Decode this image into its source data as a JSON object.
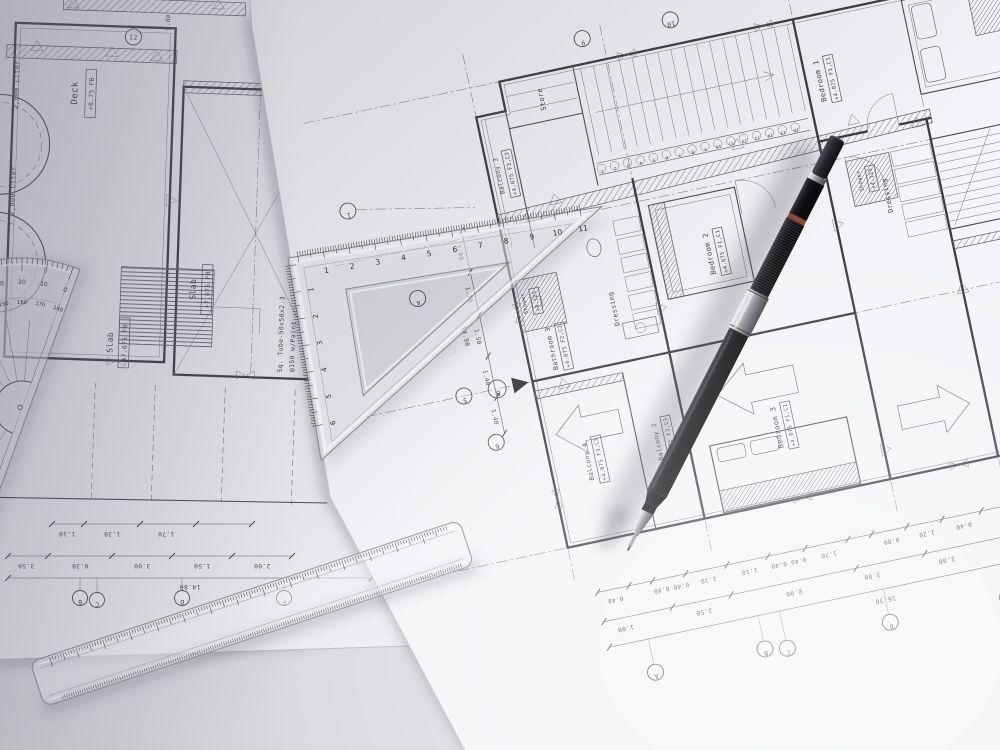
{
  "scene": {
    "description": "Top-down photograph of architectural floor-plan blueprints on a desk with a protractor, a set square, a 15 cm ruler and a black clutch pencil",
    "colors": {
      "desk": "#d9dade",
      "paper_left": "#ebecef",
      "paper_right": "#f3f4f7",
      "ink": "#44444c",
      "wall": "#3a3a43",
      "pencil_body": "#121214",
      "pencil_metal": "#c9c9ce",
      "pencil_ring": "#8a4a38"
    }
  },
  "left_sheet": {
    "deck_room": {
      "name": "Deck",
      "level": "+0.75 FB"
    },
    "tank_label_1": "2,000 Liter",
    "tank_label_2": "2,000 Liter",
    "bubble_12": "12",
    "dim_0_80": "0.80",
    "slab_1": {
      "name": "Slab",
      "level": "+7.675 FB"
    },
    "slab_2": {
      "name": "Slab",
      "level": "+7.675 FB"
    },
    "note_line_1": "Sq. Tube-50x50x2.3",
    "note_line_2": "@150 w/Paint",
    "dims_row1": [
      "1.10",
      "1.30",
      "1.70"
    ],
    "dims_row2": [
      "3.50",
      "0.30",
      "3.00",
      "1.50",
      "2.00"
    ],
    "dim_total": "14.80",
    "grid_bubbles": [
      "B",
      "C",
      "D",
      "F"
    ]
  },
  "right_sheet": {
    "rooms": [
      {
        "name": "Store",
        "level": ""
      },
      {
        "name": "Bedroom 1",
        "level": "+4.075 F1,C1"
      },
      {
        "name": "Bedroom 2",
        "level": "+4.075 F1,C1"
      },
      {
        "name": "Bedroom 3",
        "level": "+4.075 F1,C1"
      },
      {
        "name": "Bathroom 3",
        "level": "+4.075 F2,C2"
      },
      {
        "name": "Shower",
        "level": "+4.125"
      },
      {
        "name": "Shower",
        "level": "+4.125"
      },
      {
        "name": "Dressing",
        "level": ""
      },
      {
        "name": "Dressing",
        "level": ""
      },
      {
        "name": "Balcony 1",
        "level": "+4.075 F3,C3"
      },
      {
        "name": "Balcony 2",
        "level": "+4.075 F3,C3"
      },
      {
        "name": "Balcony 3",
        "level": "+4.075 F3,C3"
      },
      {
        "name": "Balcony 4",
        "level": "+4.075 F3,C3"
      },
      {
        "name": "Slab",
        "level": "+3.90 FB"
      }
    ],
    "note_line_1": "Sq. Tube-50x50x2.3",
    "note_line_2": "@150 w/Paint",
    "stair_risers": [
      "1",
      "2",
      "3",
      "4",
      "5",
      "6",
      "7",
      "8",
      "9",
      "10",
      "11",
      "12",
      "13",
      "14",
      "15",
      "16"
    ],
    "dims_row1": [
      "0.40",
      "0.40 0.40",
      "1.10",
      "1.10",
      "0.40 0.40",
      "1.70",
      "0.80",
      "1.20",
      "0.40",
      "3.40"
    ],
    "dims_row2": [
      "1.00",
      "3.50",
      "0.90",
      "3.00",
      "2.00",
      "4.30",
      "1.50"
    ],
    "dim_total": "16.30",
    "left_dims": [
      "1.00",
      "1.20",
      "1.50",
      "1.40",
      "1.40"
    ],
    "left_dim_total": "14.90",
    "grid_letters": [
      "A",
      "B",
      "C",
      "D",
      "E",
      "F"
    ],
    "grid_numbers": [
      "1",
      "4",
      "5",
      "6",
      "9",
      "10"
    ],
    "section_marker": "B"
  },
  "tools": {
    "protractor": {
      "degrees": [
        "0",
        "10",
        "20",
        "30",
        "40",
        "50",
        "60",
        "70",
        "80",
        "90",
        "100",
        "110",
        "120",
        "130",
        "140",
        "150",
        "160",
        "170",
        "180"
      ]
    },
    "set_square": {
      "top_scale": [
        "1",
        "2",
        "3",
        "4",
        "5",
        "6",
        "7",
        "8",
        "9",
        "10",
        "11"
      ],
      "side_scale": [
        "1",
        "2",
        "3",
        "4",
        "5",
        "6"
      ]
    },
    "ruler": {
      "scale": [
        "1",
        "2",
        "3",
        "4",
        "5",
        "6",
        "7",
        "8",
        "9",
        "10",
        "11",
        "12",
        "13",
        "14",
        "15"
      ]
    }
  }
}
